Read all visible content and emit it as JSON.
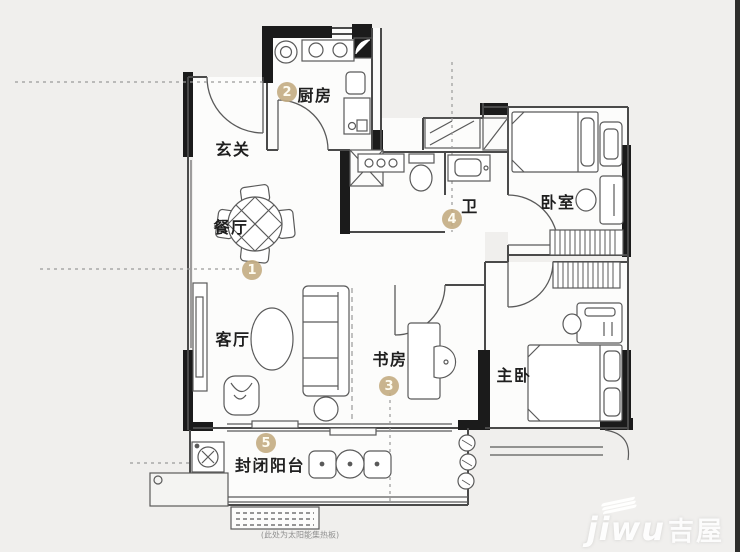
{
  "page": {
    "background": "#f0efed",
    "right_edge_color": "#2e2e2c"
  },
  "floorplan": {
    "rooms": [
      {
        "id": "entrance",
        "label": "玄关",
        "number": ""
      },
      {
        "id": "kitchen",
        "label": "厨房",
        "number": "2"
      },
      {
        "id": "dining",
        "label": "餐厅",
        "number": "1"
      },
      {
        "id": "living",
        "label": "客厅",
        "number": ""
      },
      {
        "id": "study",
        "label": "书房",
        "number": "3"
      },
      {
        "id": "bathroom",
        "label": "卫",
        "number": "4"
      },
      {
        "id": "bedroom",
        "label": "卧室",
        "number": ""
      },
      {
        "id": "master-bedroom",
        "label": "主卧",
        "number": ""
      },
      {
        "id": "balcony",
        "label": "封闭阳台",
        "number": "5"
      }
    ],
    "footnote": "(此处为太阳能集热板)",
    "marker_color": "#c4ad83",
    "wall_color": "#1b1b1b",
    "line_color": "#4a4a4a"
  },
  "watermark": {
    "latin": "jiwu",
    "cjk": "吉屋"
  }
}
